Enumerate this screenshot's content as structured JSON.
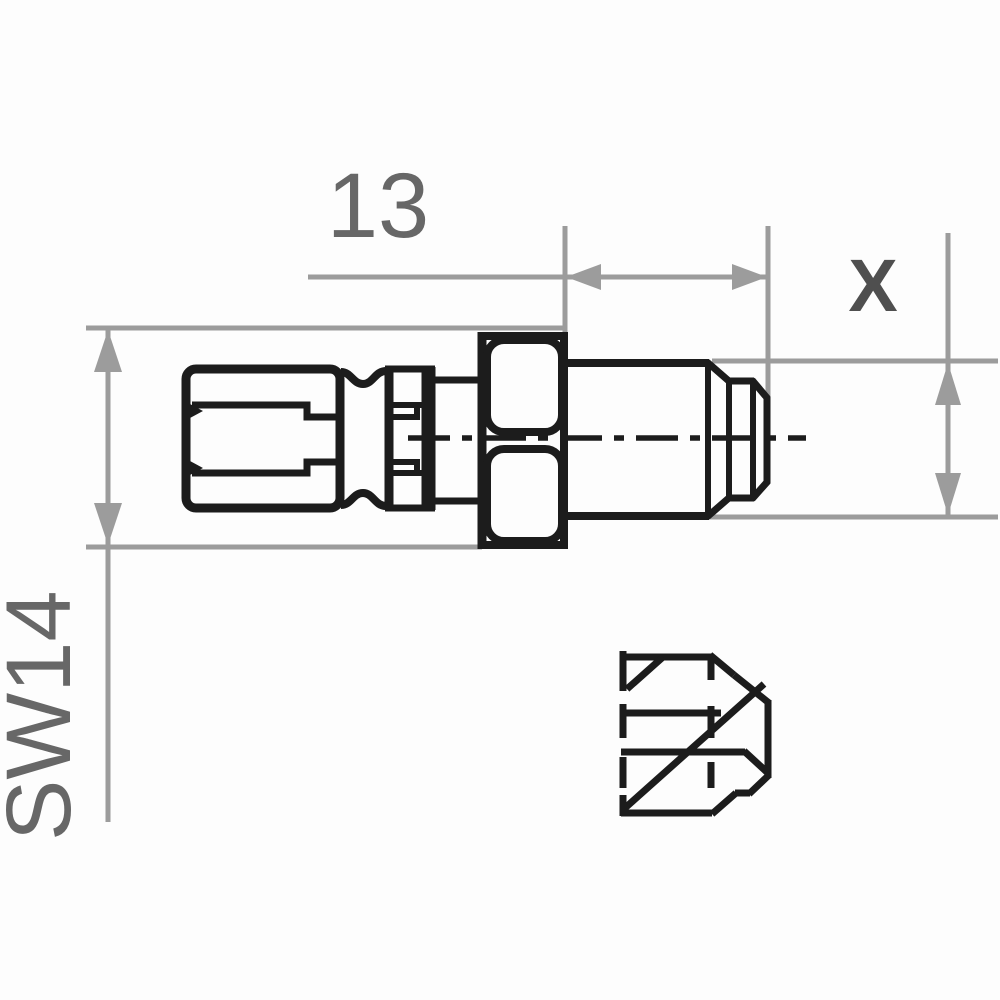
{
  "labels": {
    "length_dimension": "13",
    "thread_size": "X",
    "wrench_size": "SW14"
  },
  "colors": {
    "line_black": "#1c1c1c",
    "dimension_gray": "#9c9c9c",
    "dim_text_gray": "#676767",
    "thread_text_gray": "#4f4f4f",
    "background": "#fdfdfd"
  }
}
